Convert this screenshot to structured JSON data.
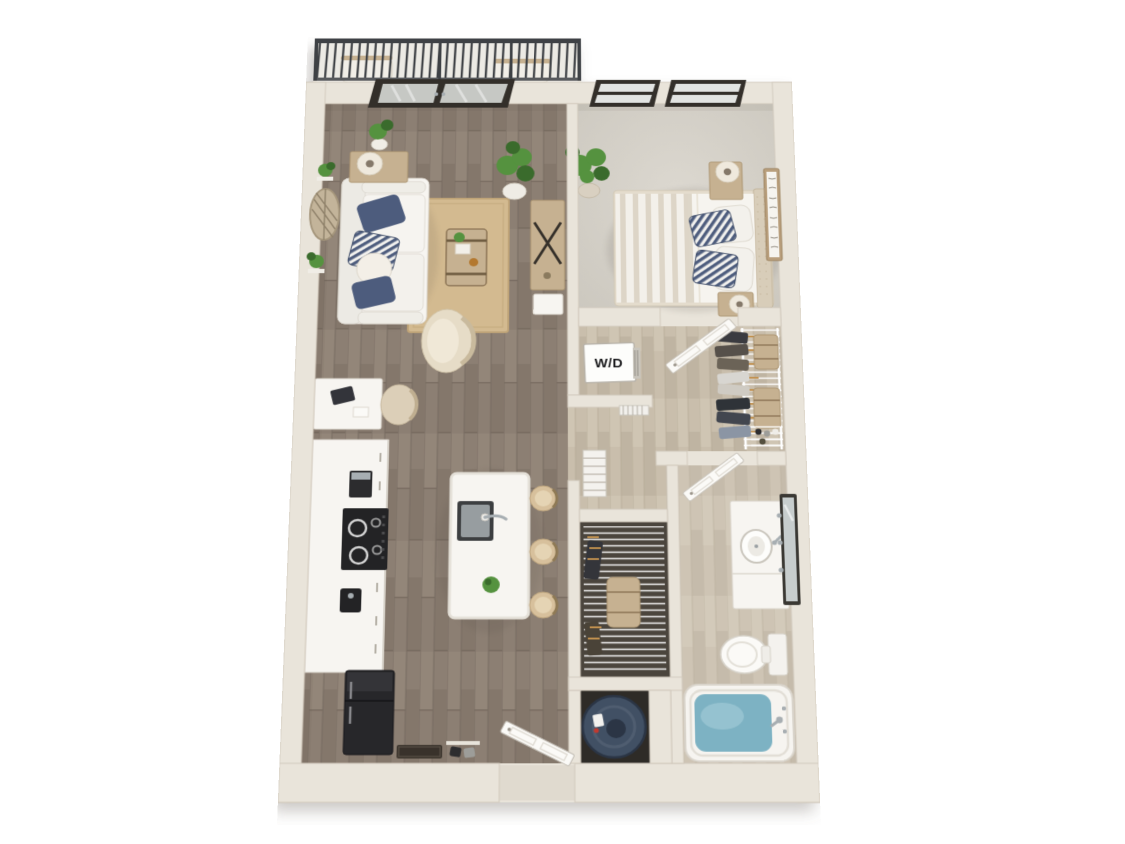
{
  "scene": {
    "type": "3d-floor-plan",
    "labels": {
      "washer_dryer": "W/D"
    },
    "rooms": [
      {
        "name": "balcony",
        "items": [
          "railing",
          "patio-chair",
          "patio-chair"
        ]
      },
      {
        "name": "living-room",
        "items": [
          "french-doors",
          "sofa",
          "navy-pillows",
          "area-rug",
          "trunk-coffee-table",
          "barrel-chair",
          "media-console",
          "console-table",
          "table-lamp",
          "fiddle-leaf-plant",
          "door-plant",
          "wall-basket-decor",
          "wall-plants",
          "desk",
          "desk-chair",
          "laptop"
        ]
      },
      {
        "name": "bedroom",
        "items": [
          "windows",
          "carpet",
          "bed",
          "striped-duvet",
          "headboard",
          "navy-striped-pillows",
          "nightstand",
          "table-lamp",
          "nightstand",
          "table-lamp",
          "potted-plant",
          "wall-art"
        ]
      },
      {
        "name": "laundry-closet",
        "items": [
          "stacked-washer-dryer"
        ]
      },
      {
        "name": "walk-in-closet",
        "items": [
          "door",
          "wire-shelving",
          "hanging-clothes",
          "storage-cases",
          "shoe-rack"
        ]
      },
      {
        "name": "hallway",
        "items": [
          "louver-panel",
          "floor-grille"
        ]
      },
      {
        "name": "bathroom",
        "items": [
          "door",
          "vanity",
          "round-sink",
          "faucet",
          "mirror",
          "sconces",
          "toilet",
          "bathtub",
          "tub-water"
        ]
      },
      {
        "name": "linen-closet",
        "items": [
          "wire-shelves",
          "storage-box",
          "hangers"
        ]
      },
      {
        "name": "utility-closet",
        "items": [
          "water-heater"
        ]
      },
      {
        "name": "kitchen",
        "items": [
          "counter-cabinets",
          "cooktop",
          "coffee-maker",
          "small-appliance",
          "refrigerator",
          "island",
          "island-sink",
          "gooseneck-faucet",
          "island-plant",
          "bar-stool",
          "bar-stool",
          "bar-stool"
        ]
      },
      {
        "name": "entry",
        "items": [
          "front-door",
          "doormat",
          "shoes"
        ]
      }
    ],
    "colors": {
      "page_bg": "#ffffff",
      "wall": "#e9e4da",
      "wall_line": "#d2cabd",
      "wood": "#8c7f73",
      "wood_dark": "#776b60",
      "wood_light": "#9b8e81",
      "floor_light": "#c9beac",
      "floor_light_dark": "#b5a996",
      "carpet": "#d8d4cc",
      "carpet_edge": "#c7c3ba",
      "rug": "#d3ba90",
      "rug_line": "#bfa478",
      "white_f": "#f7f5f1",
      "white_edge": "#d9d4cb",
      "navy": "#4d5c7d",
      "navy_deep": "#39465f",
      "tan_wood": "#c6b191",
      "tan_dark": "#ab9470",
      "cream": "#ece4d4",
      "black": "#232325",
      "steel": "#a7aeb2",
      "green": "#55923f",
      "green_dark": "#3a6b2c",
      "water": "#7db2c3",
      "water_hi": "#a9d0da",
      "heater": "#415064",
      "heater_dark": "#2b3545",
      "glass": "#e2e4e2",
      "glass_door": "#c6c8c4",
      "frame_dark": "#332f2a",
      "rail": "#3e4145",
      "closet_bg": "#4b453d",
      "orange": "#c2914f",
      "mat": "#39322b",
      "label": "#1b1b1d"
    }
  }
}
